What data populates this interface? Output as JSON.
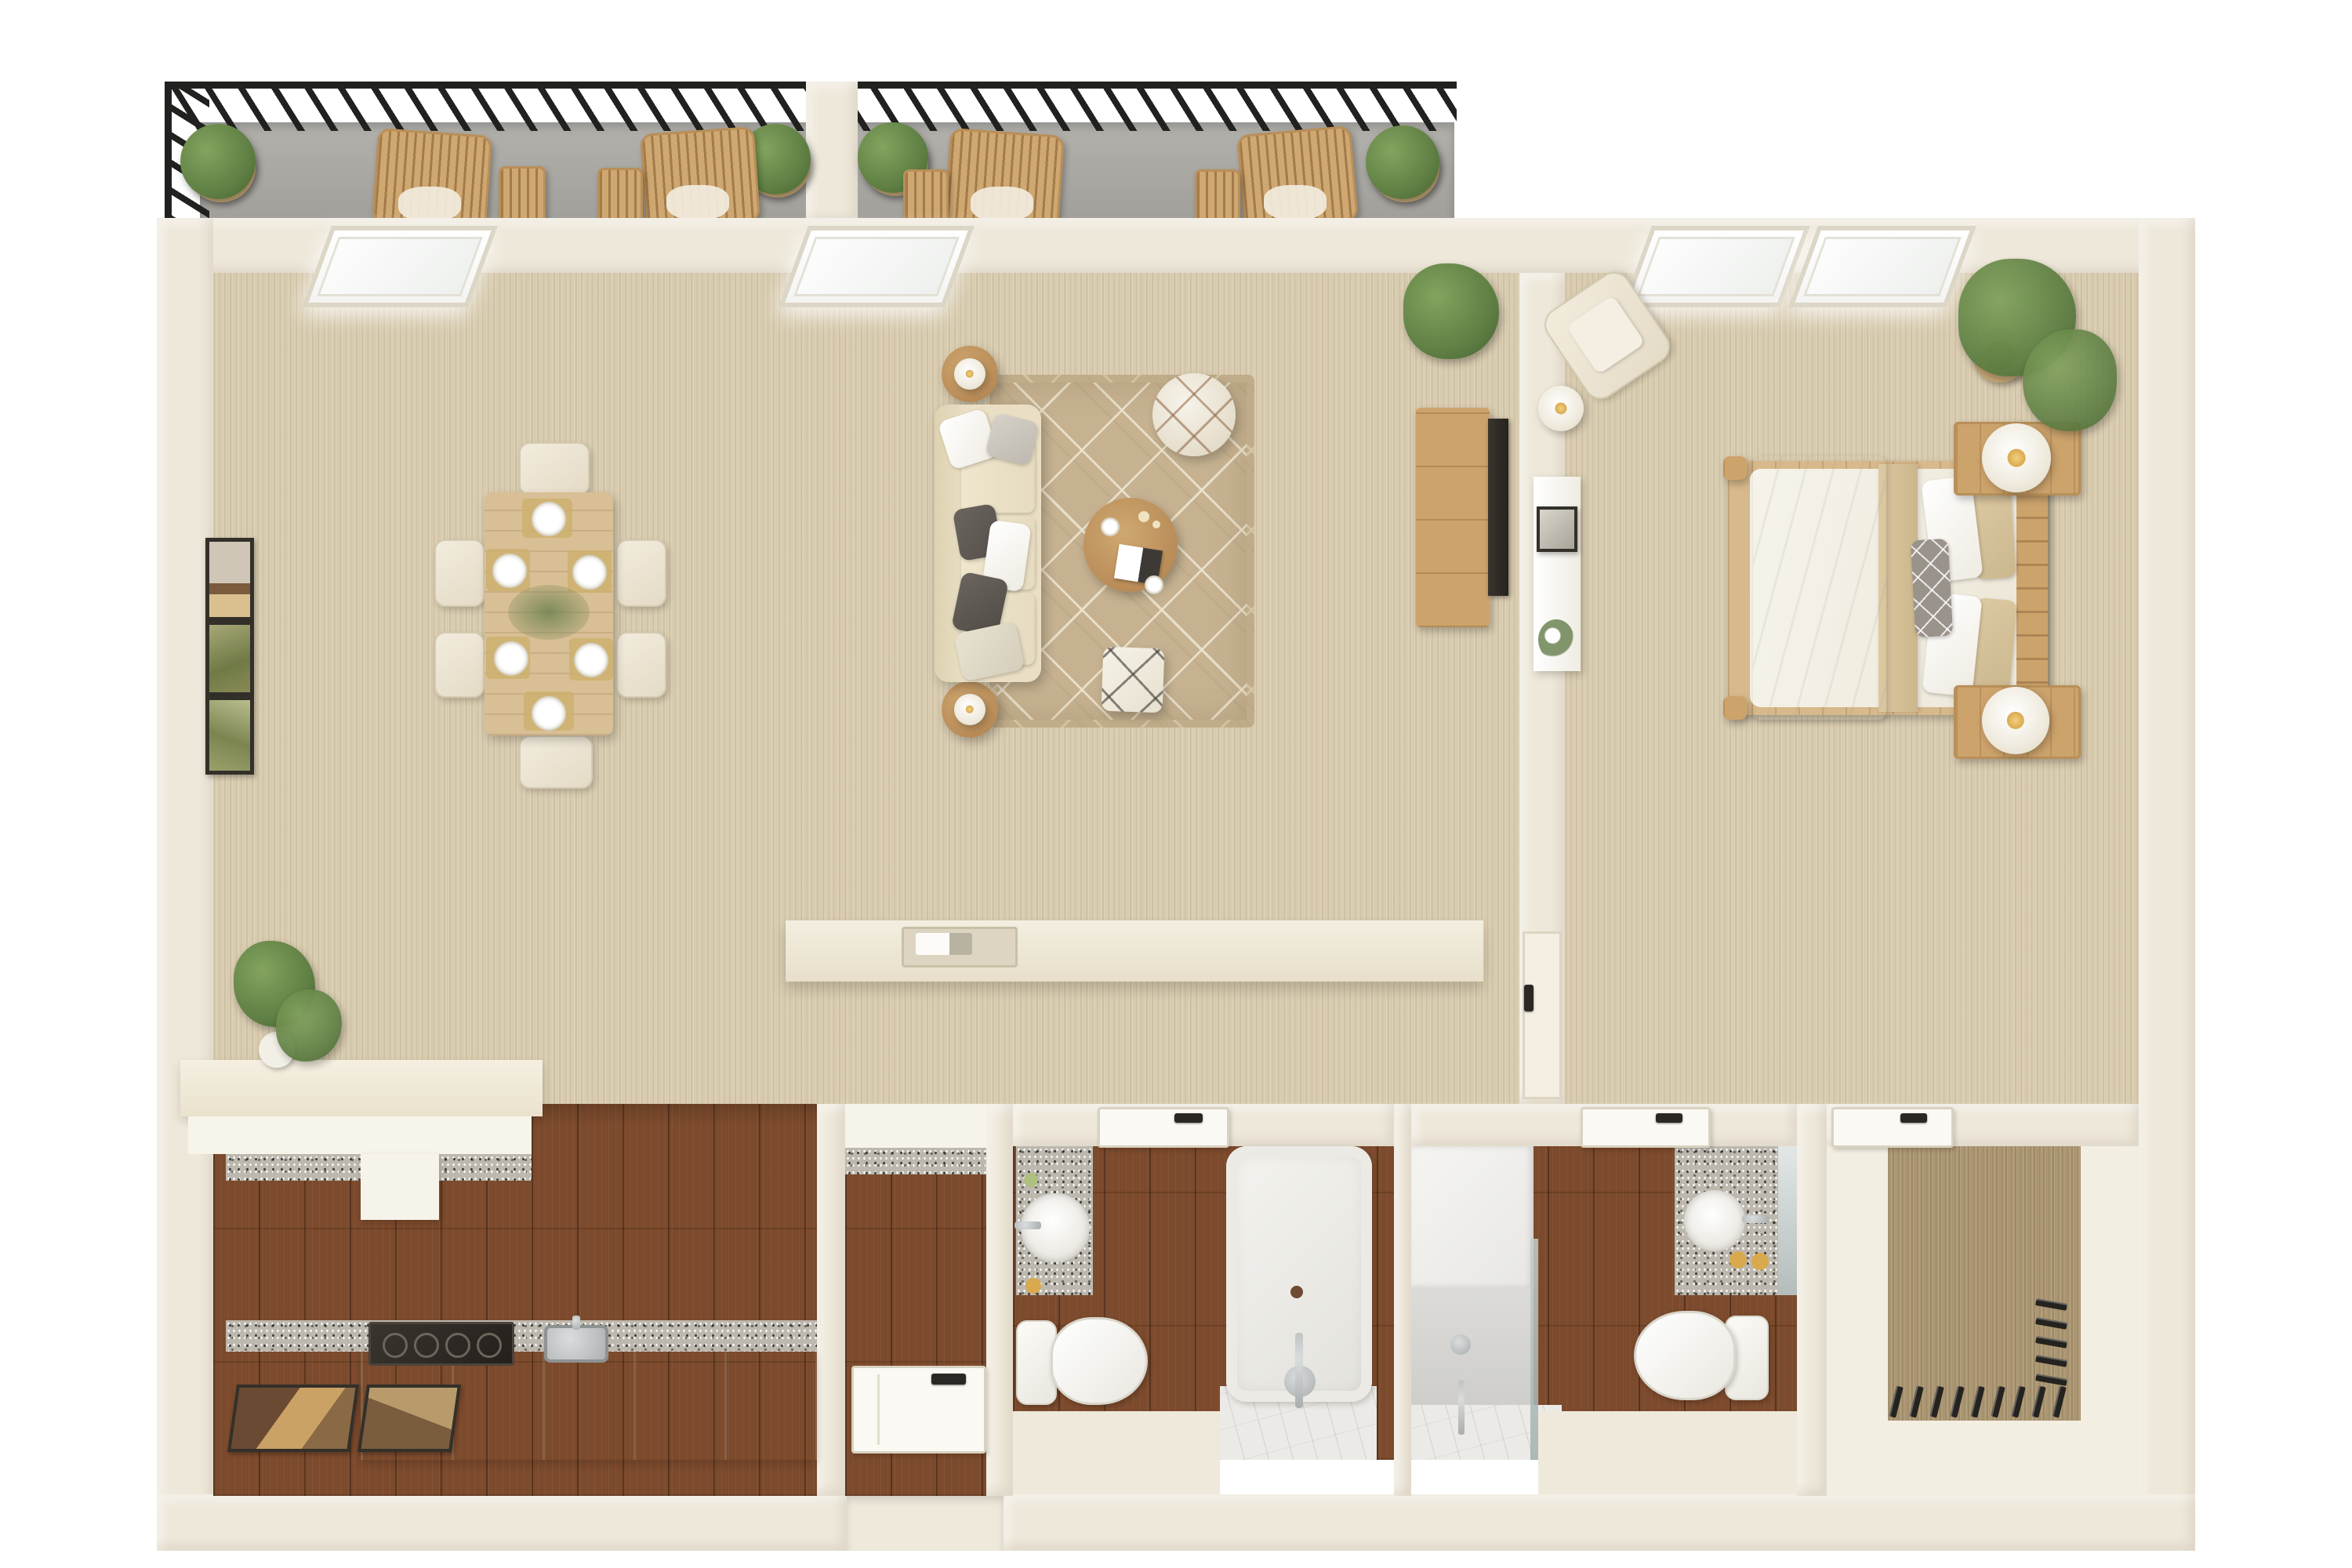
{
  "meta": {
    "title": "3D top-down floor plan — one-bedroom apartment",
    "visible_text": ""
  },
  "colors": {
    "wall": "#eee8da",
    "wallShade": "#dcd3bf",
    "carpet": "#d8cbae",
    "closetCarpet": "#ab9671",
    "wood": "#7c4a2c",
    "balcony": "#a8a6a1",
    "railing": "#21211f",
    "granite": "#bdb8ae",
    "marble": "#eceae6",
    "cream": "#f0e9da",
    "furnWood": "#cda36c",
    "furnWoodLight": "#d9bf95",
    "tan": "#cdb06e",
    "rug": "#c6b291",
    "rugLine": "rgba(238,229,207,0.9)",
    "green": "#5f7f44",
    "pot": "#c8a877",
    "gold": "#d9a94e",
    "steel": "#b9bcbc",
    "tv": "#27221e",
    "white": "#fbfaf6",
    "pillowDark": "#55504a",
    "pillowGray": "#8f8b84"
  },
  "rooms": {
    "balcony": {
      "label": "Balcony",
      "items": [
        "black metal railing",
        "divider wall",
        "4 potted shrubs",
        "4 rattan lounge chairs",
        "4 side tables"
      ]
    },
    "living": {
      "label": "Living and dining room",
      "items": [
        "dining table with 6 place settings",
        "6 upholstered chairs",
        "3 wall art frames",
        "beige sofa with pillows",
        "2 round side tables with lamps",
        "patterned area rug",
        "round coffee table",
        "round pouf",
        "square pouf",
        "TV console",
        "wall TV",
        "potted plant",
        "breakfast bar with tray",
        "monstera plant on counter"
      ]
    },
    "bedroom": {
      "label": "Bedroom",
      "items": [
        "double bed with wood frame",
        "2 nightstands with sphere lamps",
        "armchair",
        "floor lamp",
        "white console with art and flowers",
        "large potted plant"
      ]
    },
    "kitchen": {
      "label": "Kitchen",
      "items": [
        "peninsula counter with granite top",
        "lower cabinets",
        "cooktop",
        "stainless sink",
        "2 floor mats"
      ]
    },
    "hallway": {
      "label": "Entry hallway",
      "items": [
        "open front door"
      ]
    },
    "bath1": {
      "label": "Main bathroom",
      "items": [
        "granite vanity with round sink",
        "toilet",
        "bathtub with marble floor"
      ]
    },
    "bath2": {
      "label": "En-suite bathroom",
      "items": [
        "walk-in shower with glass panel",
        "granite vanity with mirror",
        "toilet"
      ]
    },
    "closet": {
      "label": "Walk-in closet",
      "items": [
        "carpet",
        "hanging clothes on two rails"
      ]
    },
    "windows": {
      "label": "Windows",
      "count": 4
    },
    "doors": {
      "label": "Doors",
      "items": [
        "front door",
        "bathroom door",
        "en-suite door",
        "closet door",
        "hall door"
      ]
    }
  }
}
